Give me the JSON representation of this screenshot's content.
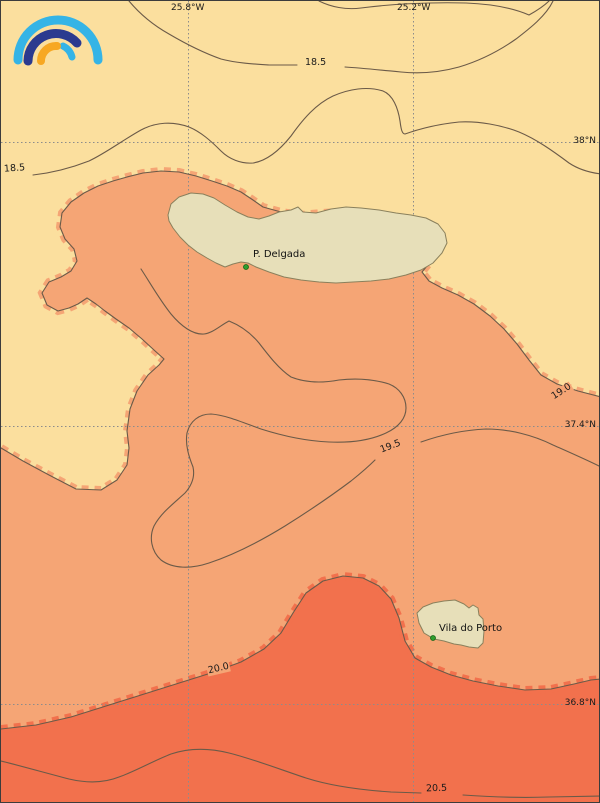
{
  "map": {
    "title": "Sea surface temperature contour map",
    "region": "Azores - Sao Miguel and Santa Maria islands",
    "isotherm_levels_c": [
      18.5,
      19.0,
      19.5,
      20.0,
      20.5
    ],
    "colors": {
      "band_lt_19": "#fbdf9e",
      "band_19_20": "#f5a575",
      "band_20_21": "#f2714d",
      "island": "#e7dfb9",
      "island_border": "#8a805c",
      "contour_line": "#6b5a48",
      "grid_line": "#8c8c8c",
      "marker_dot": "#2e9e2e",
      "logo_cyan": "#35b4e6",
      "logo_dark_blue": "#2b3a8f",
      "logo_orange": "#f7a823"
    },
    "grid": {
      "lon_labels": [
        {
          "text": "25.8°W"
        },
        {
          "text": "25.2°W"
        }
      ],
      "lat_labels": [
        {
          "text": "38°N"
        },
        {
          "text": "37.4°N"
        },
        {
          "text": "36.8°N"
        }
      ]
    },
    "contour_labels": {
      "c185_top": {
        "text": "18.5"
      },
      "c185_left": {
        "text": "18.5"
      },
      "c190": {
        "text": "19.0"
      },
      "c195": {
        "text": "19.5"
      },
      "c200": {
        "text": "20.0"
      },
      "c205": {
        "text": "20.5"
      }
    },
    "places": {
      "p_delgada": {
        "name": "P. Delgada"
      },
      "vila_do_porto": {
        "name": "Vila do Porto"
      }
    },
    "logo": {
      "name": "rainbow-arcs-logo"
    }
  }
}
